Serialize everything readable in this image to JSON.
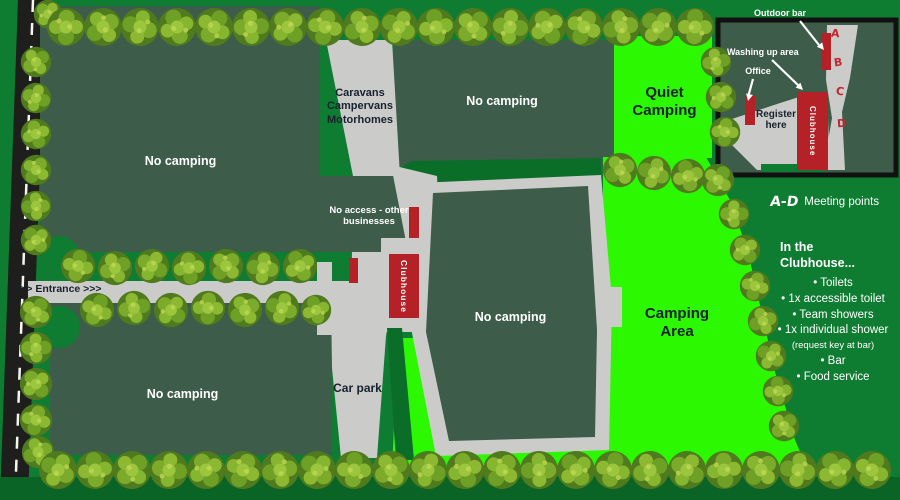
{
  "labels": {
    "entrance": ">>> Entrance >>>",
    "no_camping": "No camping",
    "quiet_camping": "Quiet\nCamping",
    "camping_area": "Camping\nArea",
    "car_park": "Car park",
    "caravans_road": "Caravans\nCampervans\nMotorhomes",
    "no_access": "No access - other\nbusinesses",
    "clubhouse": "Clubhouse"
  },
  "inset": {
    "outdoor_bar": "Outdoor bar",
    "washing_up_area": "Washing up area",
    "office": "Office",
    "register_here": "Register\nhere",
    "clubhouse": "Clubhouse",
    "meeting_points": [
      "A",
      "B",
      "C",
      "D"
    ]
  },
  "legend": {
    "range": "A-D",
    "label": "Meeting points"
  },
  "clubhouse_info": {
    "title": "In the\nClubhouse...",
    "items": [
      {
        "text": "Toilets"
      },
      {
        "text": "1x accessible toilet"
      },
      {
        "text": "Team showers"
      },
      {
        "text": "1x individual shower",
        "note": "(request key at bar)"
      },
      {
        "text": "Bar"
      },
      {
        "text": "Food service"
      }
    ]
  },
  "colors": {
    "background_green": "#0e7c31",
    "no_camping_green": "#3d5c49",
    "camping_green": "#2cf802",
    "accent_dark_green": "#0a6e28",
    "road_gray": "#cbcbca",
    "building_red": "#b42127",
    "tarmac_black": "#1e1e1c",
    "marker_red": "#c1272d"
  }
}
